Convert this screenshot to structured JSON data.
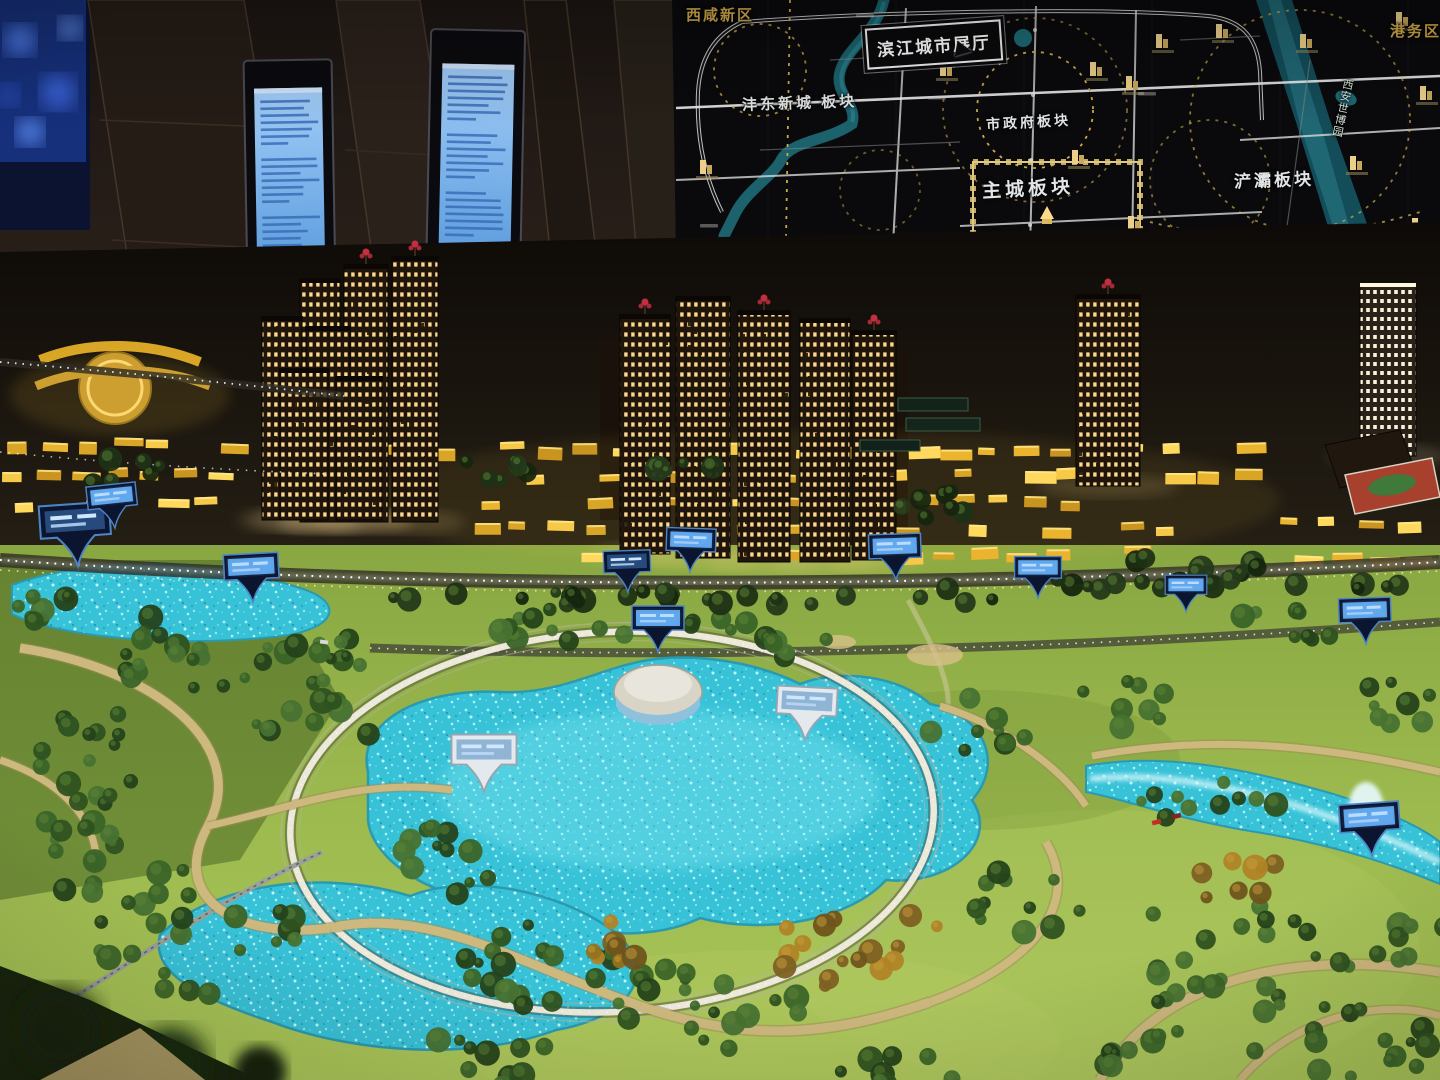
{
  "map_board": {
    "title_box_label": "滨江城市展厅",
    "labels": {
      "xixian_new_area": "西咸新区",
      "fengdong_new_town_block": "沣东新城 板块",
      "city_government_block": "市政府板块",
      "main_city_block": "主城板块",
      "port_district": "港务区",
      "chanba_block": "浐灞板块",
      "xian_expo_park": "西安世博园"
    }
  },
  "palette": {
    "map_gold_accent": "#cfa94a",
    "map_river_teal": "#1e6b76",
    "model_window_glow": "#ffd98a",
    "lowrise_amber": "#eab42e",
    "lake_cyan": "#45cede",
    "lawn_green": "#9ab84c",
    "kiosk_screen_blue": "#7ab2ee",
    "sign_screen_blue": "#58a0e8"
  }
}
